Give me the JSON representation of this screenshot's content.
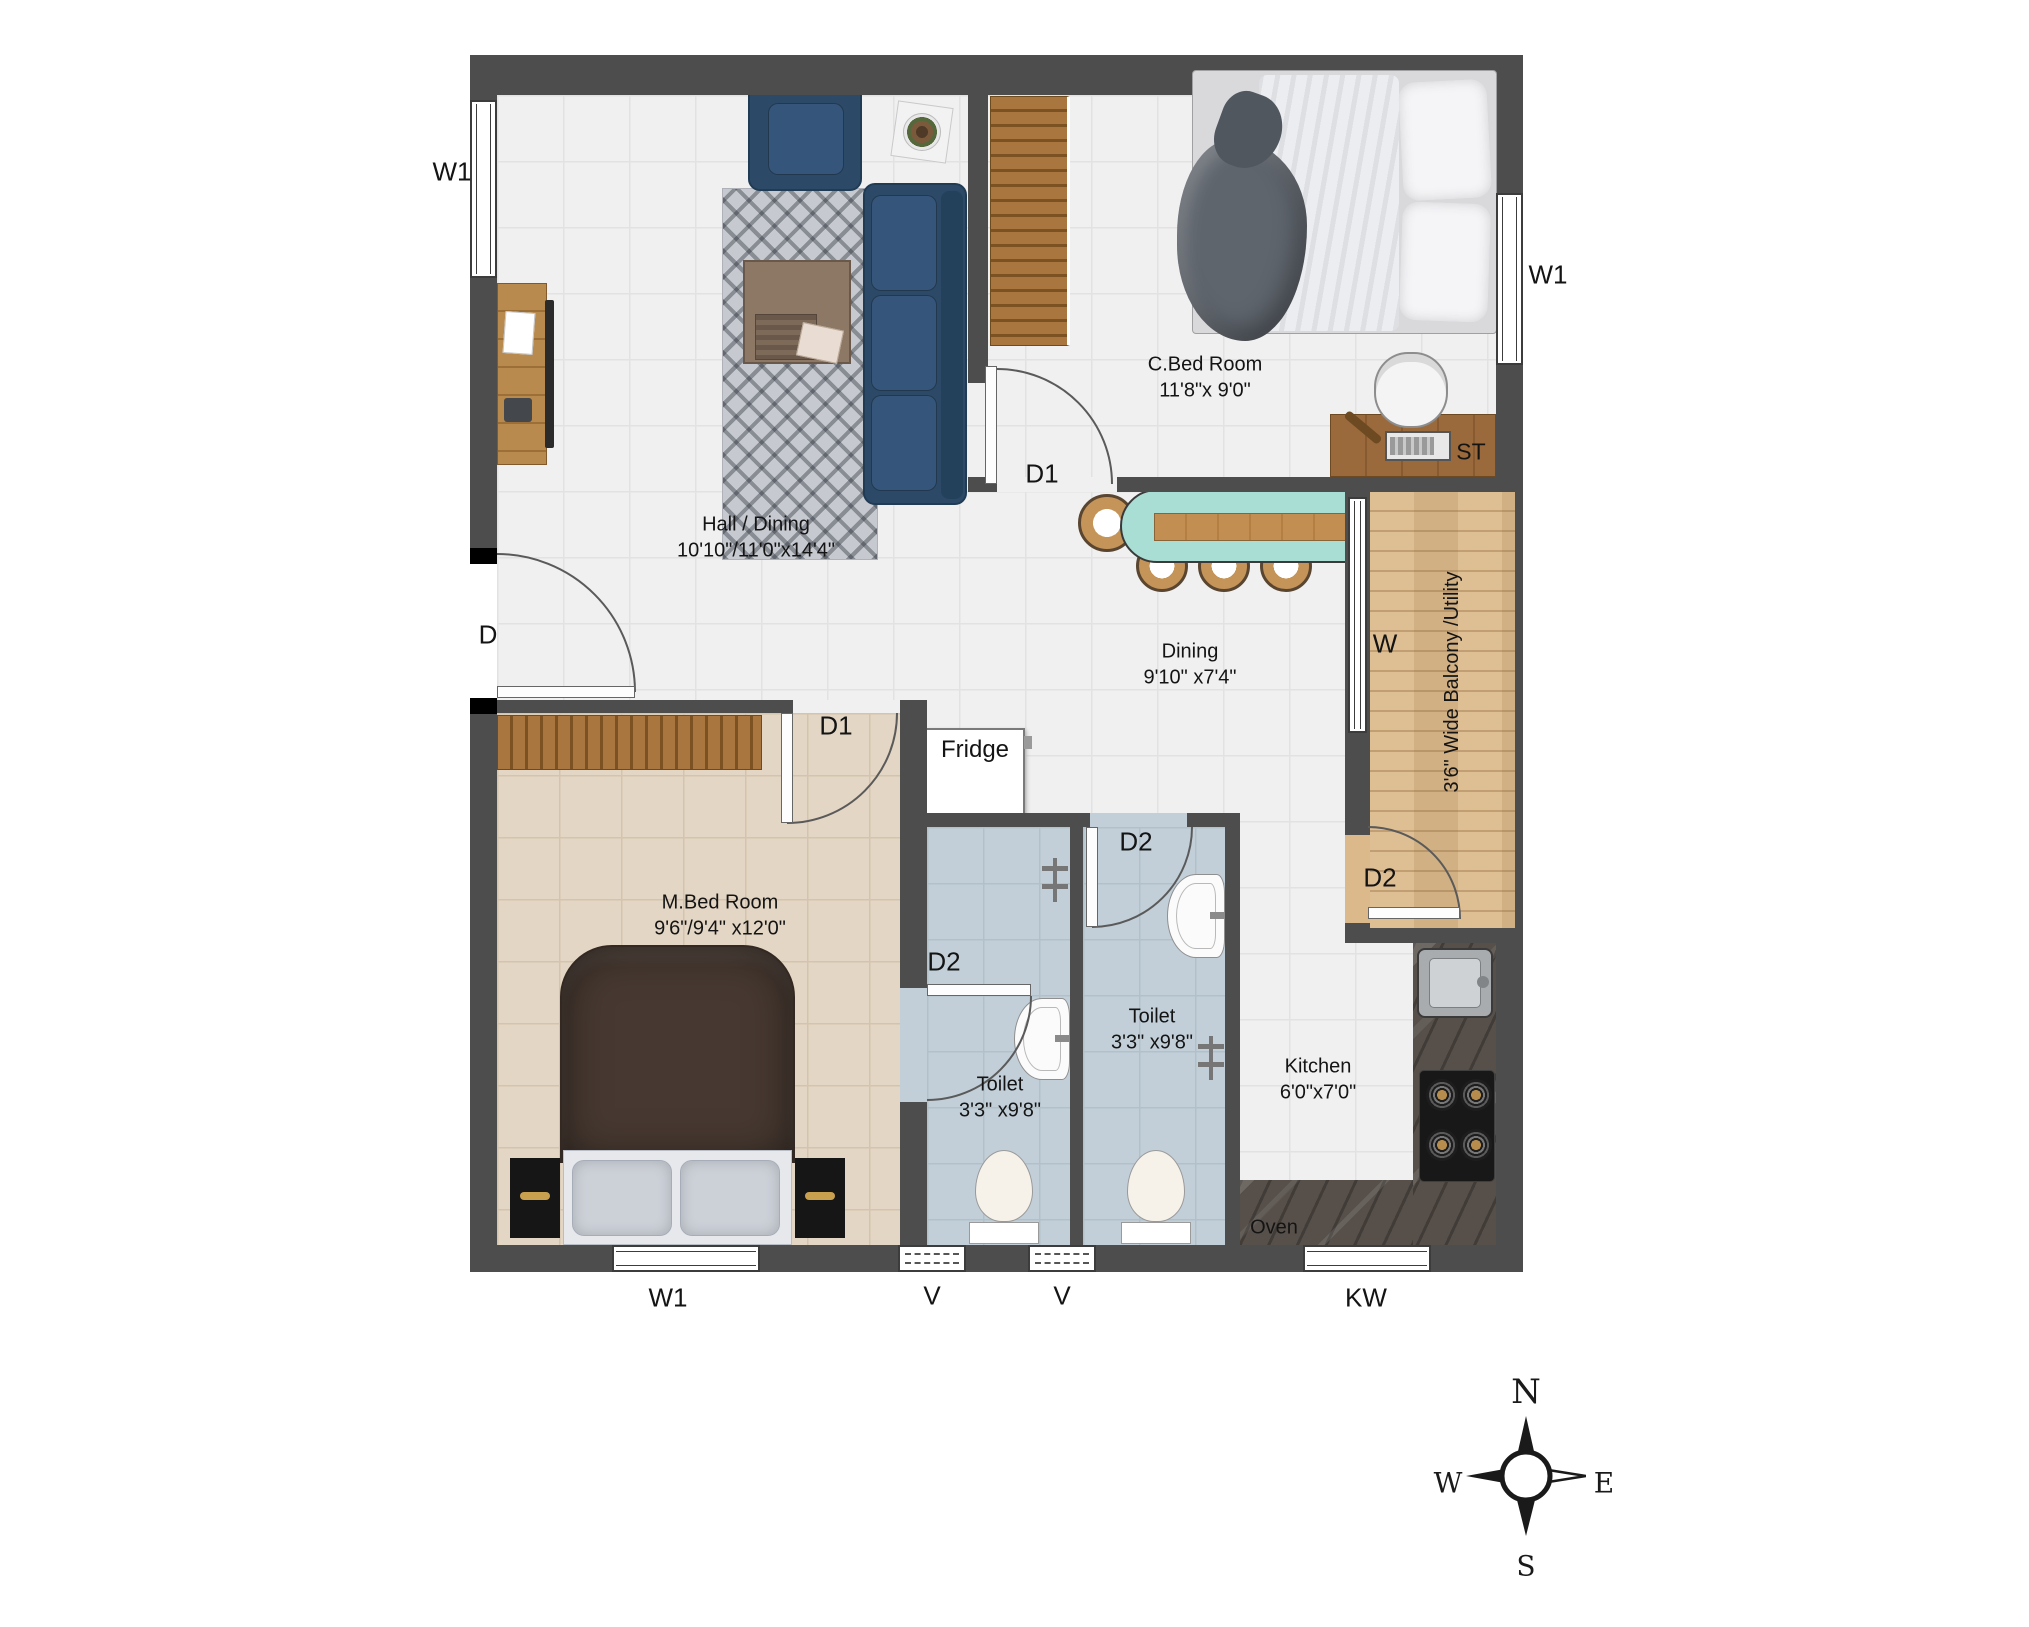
{
  "plan": {
    "rooms": {
      "hall": {
        "name": "Hall / Dining",
        "dims": "10'10\"/11'0\"x14'4\""
      },
      "cbed": {
        "name": "C.Bed Room",
        "dims": "11'8\"x 9'0\""
      },
      "dining": {
        "name": "Dining",
        "dims": "9'10\" x7'4\""
      },
      "mbed": {
        "name": "M.Bed Room",
        "dims": "9'6\"/9'4\" x12'0\""
      },
      "toilet1": {
        "name": "Toilet",
        "dims": "3'3\" x9'8\""
      },
      "toilet2": {
        "name": "Toilet",
        "dims": "3'3\" x9'8\""
      },
      "kitchen": {
        "name": "Kitchen",
        "dims": "6'0\"x7'0\""
      },
      "balcony": {
        "name": "3'6\" Wide Balcony /Utility"
      }
    },
    "markers": {
      "w1_left": "W1",
      "w1_right": "W1",
      "w1_bottom": "W1",
      "v1": "V",
      "v2": "V",
      "kw": "KW",
      "d": "D",
      "d1_cbed": "D1",
      "d1_mbed": "D1",
      "d2_toilet1": "D2",
      "d2_toilet2": "D2",
      "d2_balcony": "D2",
      "st": "ST",
      "w": "W"
    },
    "appliances": {
      "fridge": "Fridge",
      "oven": "Oven"
    },
    "compass": {
      "n": "N",
      "e": "E",
      "s": "S",
      "w": "W"
    },
    "colors": {
      "wall": "#4d4d4d",
      "floor_tile": "#f0f0f0",
      "mbed_floor": "#e4d6c4",
      "toilet_floor": "#c2cfd8",
      "balcony_wood": "#dcb98b",
      "deck_wood": "#a8763e",
      "sofa_blue": "#2c4a67",
      "dining_table_mint": "#a9ded4",
      "counter_marble": "#57504a"
    }
  }
}
